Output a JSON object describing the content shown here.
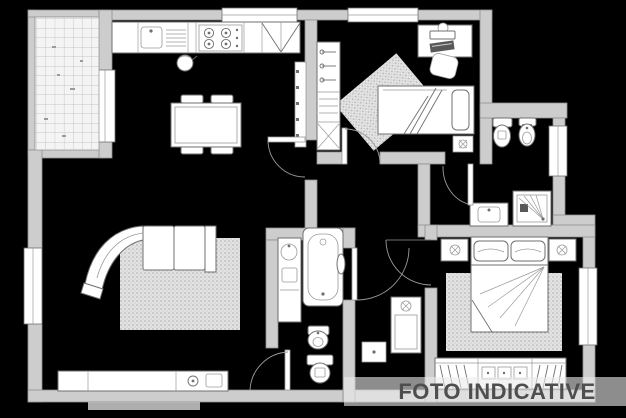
{
  "watermark": {
    "text": "FOTO INDICATIVE"
  },
  "colors": {
    "background": "#000000",
    "wall": "#cdcdcd",
    "wall_edge": "#8f8f8f",
    "line": "#6f6f6f",
    "line_light": "#9a9a9a",
    "fixture": "#ffffff",
    "tile_floor": "#f4f4f4",
    "rug_base": "#e3e3e3",
    "rug_dot": "#adadad",
    "watermark_text": "#4e4e4e",
    "watermark_band": "rgba(235,235,235,0.6)"
  },
  "plan": {
    "type": "apartment-floor-plan",
    "rooms": [
      {
        "name": "balcony",
        "features": [
          "tiled-floor",
          "balcony-door"
        ]
      },
      {
        "name": "living-room-kitchen",
        "features": [
          "kitchen-counter",
          "sink",
          "drainboard",
          "stove",
          "tall-cabinets",
          "radiator",
          "kettle",
          "dining-table",
          "four-chairs",
          "curved-sofa",
          "rug",
          "tv-sideboard",
          "window-top",
          "window-left"
        ]
      },
      {
        "name": "bedroom-2",
        "features": [
          "wardrobe-with-hangers",
          "shelf-unit",
          "desk-with-computer",
          "chair",
          "single-bed",
          "rug",
          "pouf",
          "window-top"
        ]
      },
      {
        "name": "bathroom-1",
        "features": [
          "toilet",
          "bidet",
          "washbasin",
          "shower",
          "window-right",
          "door"
        ]
      },
      {
        "name": "hallway",
        "features": [
          "kitchen-door",
          "bedroom-door"
        ]
      },
      {
        "name": "corridor",
        "features": [
          "cabinet",
          "radiator"
        ]
      },
      {
        "name": "bathroom-2",
        "features": [
          "washbasin-cabinet",
          "bathtub",
          "bidet",
          "toilet",
          "door-to-corridor",
          "door-to-living"
        ]
      },
      {
        "name": "master-bedroom",
        "features": [
          "double-bed",
          "nightstand-left",
          "nightstand-right",
          "rug",
          "wardrobe",
          "window-right",
          "door"
        ]
      }
    ]
  }
}
